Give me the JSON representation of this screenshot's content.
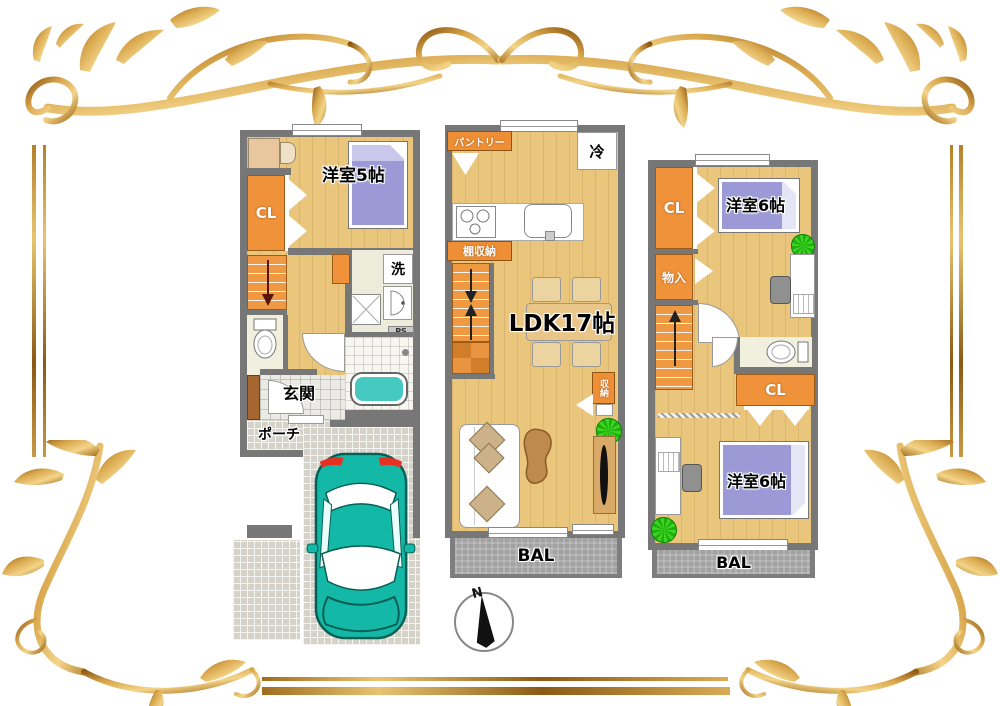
{
  "floor1": {
    "bedroom_label": "洋室5帖",
    "closet_label": "CL",
    "laundry_label": "洗",
    "pipe_space_label": "PS",
    "entrance_label": "玄関",
    "porch_label": "ポーチ"
  },
  "floor2": {
    "pantry_label": "パントリー",
    "fridge_label": "冷",
    "shelf_storage_label": "棚収納",
    "ldk_label": "LDK17帖",
    "storage_label": "収納",
    "balcony_label": "BAL"
  },
  "floor3": {
    "closet_top_label": "CL",
    "bedroom_top_label": "洋室6帖",
    "storage_label": "物入",
    "closet_middle_label": "CL",
    "bedroom_bottom_label": "洋室6帖",
    "balcony_label": "BAL"
  },
  "compass": {
    "north_label": "N"
  },
  "colors": {
    "gold": "#c89243",
    "wall_gray": "#777777",
    "wood_floor": "#eac57c",
    "closet_orange": "#f0923a",
    "bed_purple": "#9b99d6",
    "bath_teal": "#46c9c0",
    "car_teal": "#14b8a6",
    "balcony_gray": "#a2a2a2",
    "plant_green": "#2fbd17",
    "tail_light_red": "#e53022"
  }
}
